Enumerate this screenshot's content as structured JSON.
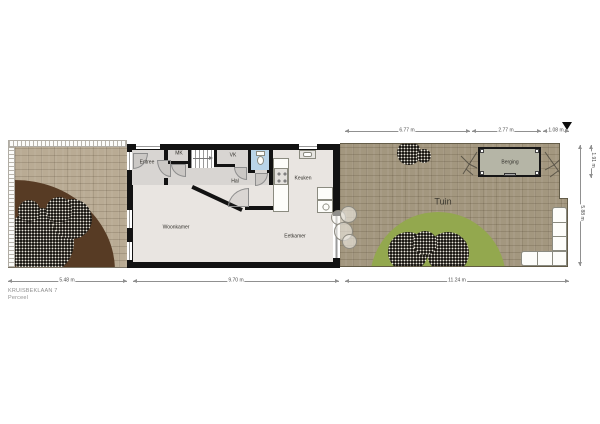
{
  "title": {
    "address": "KRUISBEKLAAN 7",
    "sheet": "Perceel"
  },
  "rooms": {
    "entree": "Entree",
    "mk": "MK",
    "vk": "VK",
    "hal": "Hal",
    "keuken": "Keuken",
    "woonkamer": "Woonkamer",
    "eetkamer": "Eetkamer"
  },
  "garden": {
    "tuin": "Tuin",
    "berging": "Berging"
  },
  "dimensions": {
    "top": [
      "6.77 m",
      "2.77 m",
      "1.08 m"
    ],
    "bottom": [
      "5.48 m",
      "9.70 m",
      "11.24 m"
    ],
    "right": [
      "1.91 m",
      "5.88 m"
    ]
  },
  "colors": {
    "paving_front": "#b9ab94",
    "paving_back": "#a3977f",
    "dirt": "#573b24",
    "lawn": "#93a84e",
    "shed": "#b5b5a6",
    "floor": "#e9e5e1",
    "floor_hall": "#d8d5d2",
    "toilet": "#b9d4e8",
    "wall": "#121212",
    "label": "#33312c"
  }
}
